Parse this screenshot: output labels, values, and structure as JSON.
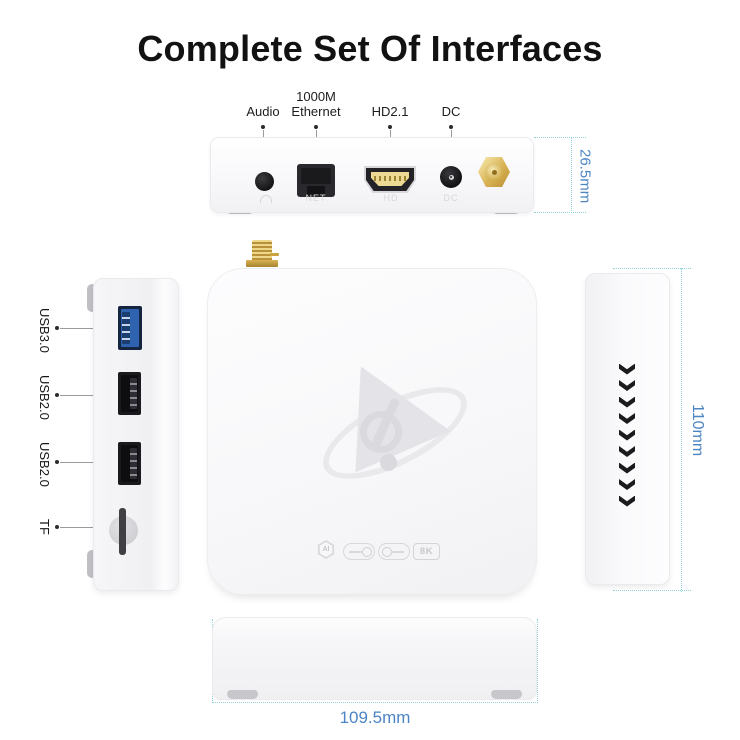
{
  "title": "Complete Set Of Interfaces",
  "back_panel": {
    "labels": {
      "audio": "Audio",
      "ethernet": "1000M\nEthernet",
      "hdmi": "HD2.1",
      "dc": "DC"
    },
    "engraved": {
      "net": "NET",
      "hd": "HD",
      "dc": "DC"
    },
    "height_dimension": "26.5mm"
  },
  "left_side": {
    "labels": {
      "usb3": "USB3.0",
      "usb2a": "USB2.0",
      "usb2b": "USB2.0",
      "tf": "TF"
    },
    "engraved": {
      "usb1": "USB1",
      "usb2": "USB2",
      "usb3": "USB3",
      "tf": "TF"
    }
  },
  "top_view": {
    "badges": {
      "ai": "AI",
      "eightk": "8K"
    }
  },
  "right_side": {
    "length_dimension": "110mm",
    "vent_chevron_count": 9
  },
  "front_view": {
    "width_dimension": "109.5mm"
  },
  "colors": {
    "dimension_text": "#4c85c4",
    "dimension_line": "#8fd2d8",
    "gold": "#d9b254",
    "usb3_blue": "#2f63b0"
  }
}
